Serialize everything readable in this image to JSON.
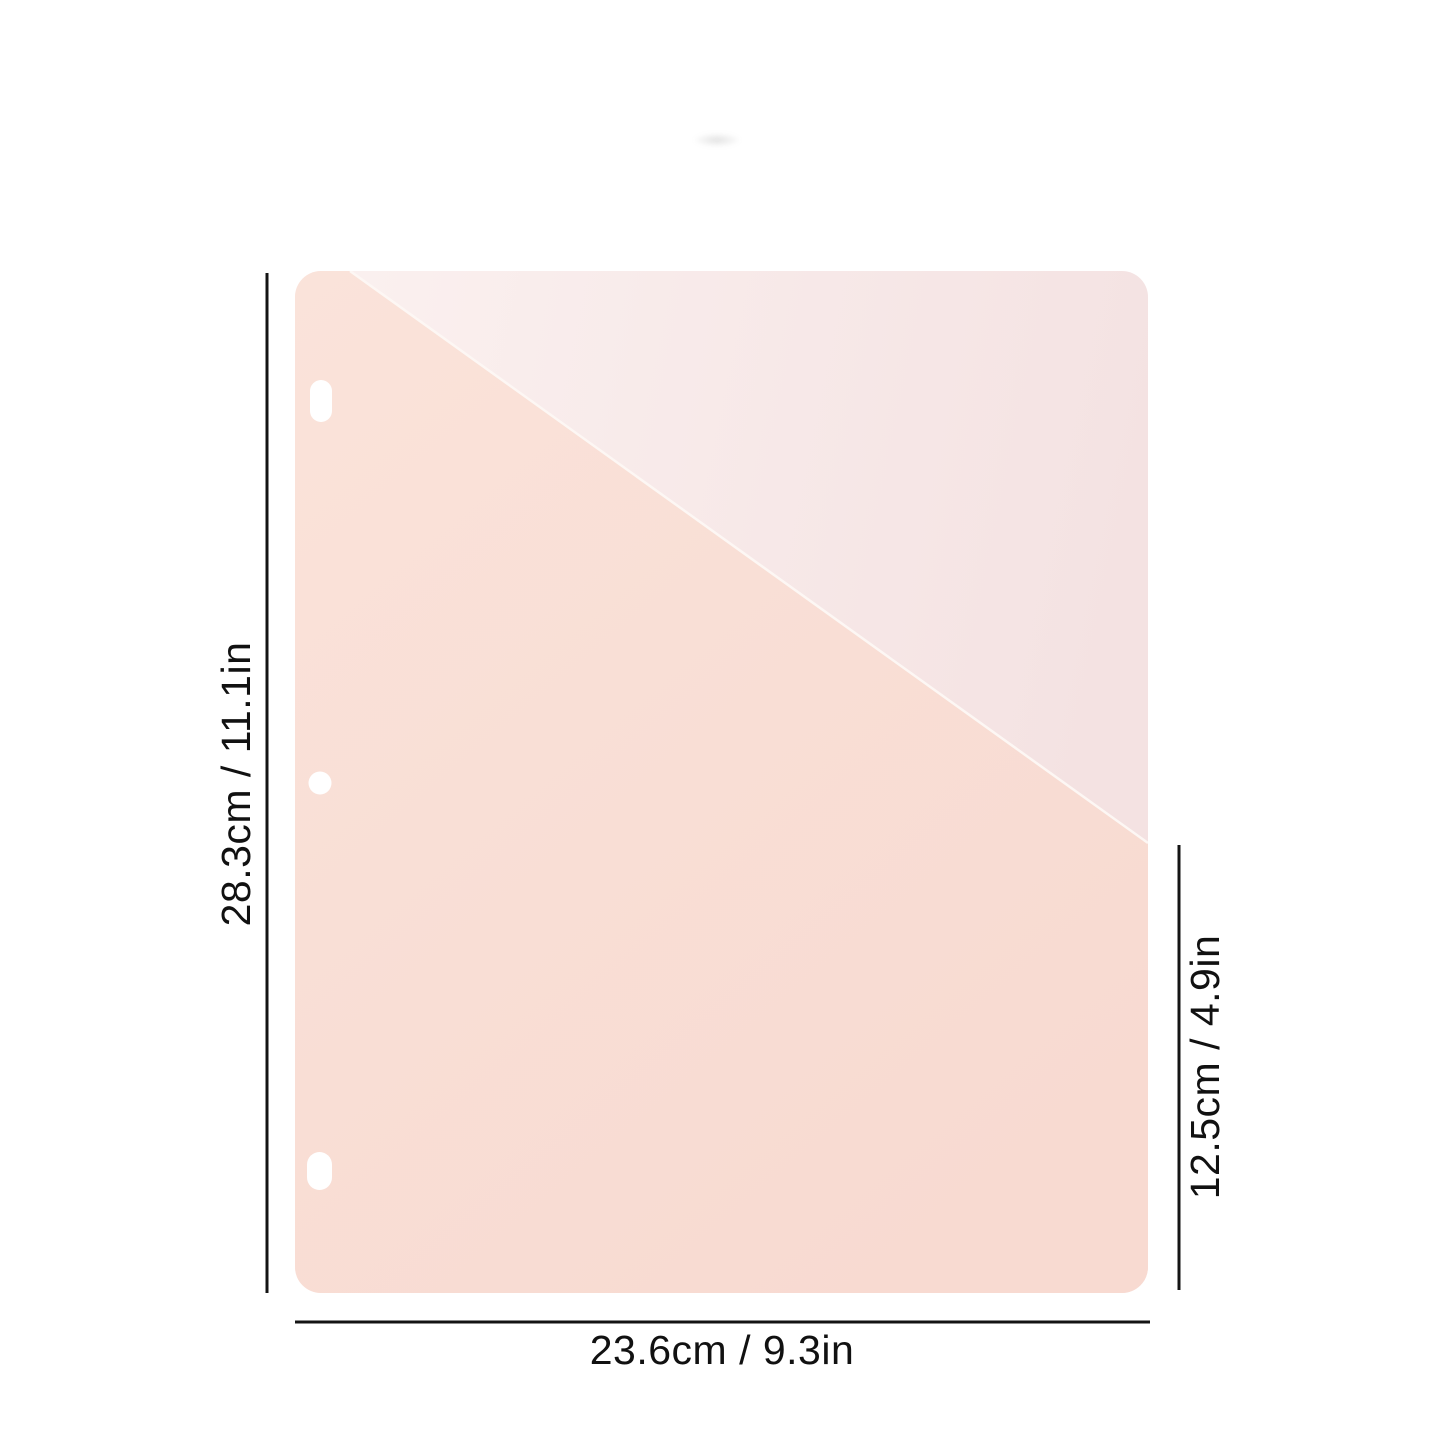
{
  "diagram": {
    "subject": "binder-pocket-divider",
    "dimensions": {
      "height_label": "28.3cm / 11.1in",
      "width_label": "23.6cm / 9.3in",
      "pocket_height_label": "12.5cm / 4.9in"
    },
    "colors": {
      "background": "#ffffff",
      "pocket_light": "#fae3da",
      "pocket_dark": "#f8dad1",
      "base_sheet_light": "#fbf1f0",
      "base_sheet_dark": "#f4e2e2",
      "diagonal_highlight": "#fdf7f4",
      "hole_fill": "#ffffff",
      "dimension_line": "#141414",
      "label_text": "#111111"
    }
  }
}
